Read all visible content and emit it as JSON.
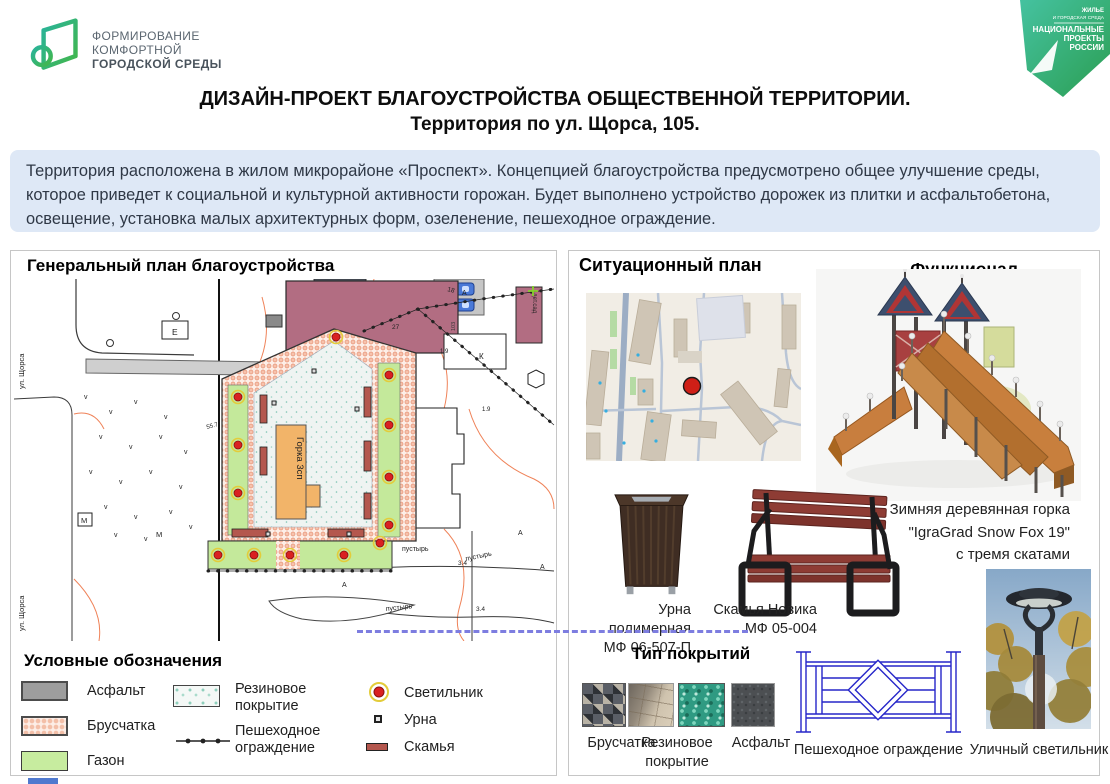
{
  "header": {
    "logo": {
      "line1": "ФОРМИРОВАНИЕ",
      "line2": "КОМФОРТНОЙ",
      "line3": "ГОРОДСКОЙ СРЕДЫ"
    },
    "badge": {
      "top1": "ЖИЛЬЕ",
      "top2": "И ГОРОДСКАЯ СРЕДА",
      "line1": "НАЦИОНАЛЬНЫЕ",
      "line2": "ПРОЕКТЫ",
      "line3": "РОССИИ"
    },
    "title_line1": "ДИЗАЙН-ПРОЕКТ БЛАГОУСТРОЙСТВА ОБЩЕСТВЕННОЙ ТЕРРИТОРИИ.",
    "title_line2": "Территория по ул. Щорса, 105."
  },
  "description": "Территория расположена в жилом микрорайоне «Проспект». Концепцией благоустройства предусмотрено общее улучшение среды, которое приведет к социальной и культурной активности горожан. Будет выполнено устройство дорожек из плитки и асфальтобетона, освещение, установка малых архитектурных форм, озеленение, пешеходное ограждение.",
  "general_plan": {
    "title": "Генеральный план благоустройства",
    "map_labels": {
      "slide": "Горка 3сп",
      "wasteland": "пустырь",
      "garages": "гаражи",
      "street": "ул. Щорса",
      "kindergarten": "дет.сад",
      "letter_a": "А",
      "letter_k": "К",
      "letter_m": "М",
      "letter_e": "Е",
      "num_27": "27",
      "num_18": "18",
      "num_19": "1.9",
      "num_34": "3.4",
      "num_557": "55.7",
      "building_103": "103"
    }
  },
  "legend": {
    "title": "Условные обозначения",
    "items": [
      {
        "label": "Асфальт"
      },
      {
        "label": "Брусчатка"
      },
      {
        "label": "Газон"
      },
      {
        "label": "Резиновое покрытие"
      },
      {
        "label": "Пешеходное ограждение"
      },
      {
        "label": "Светильник"
      },
      {
        "label": "Урна"
      },
      {
        "label": "Скамья"
      }
    ]
  },
  "situational_plan": {
    "title": "Ситуационный план"
  },
  "functional": {
    "title": "Функционал",
    "slide_caption": [
      "Зимняя деревянная горка",
      "\"IgraGrad Snow Fox 19\"",
      "с тремя скатами"
    ]
  },
  "furniture": {
    "urn_caption": [
      "Урна полимерная",
      "МФ 06-507-П"
    ],
    "bench_caption": [
      "Скамья Новика",
      "МФ 05-004"
    ]
  },
  "coverings": {
    "title": "Тип покрытий",
    "labels": [
      "Брусчатка",
      "Резиновое покрытие",
      "Асфальт"
    ],
    "fence_label": "Пешеходное ограждение",
    "lamp_label": "Уличный светильник"
  },
  "colors": {
    "accent_green": "#2fa25c",
    "accent_teal": "#28b09c",
    "band_blue": "#dee8f6",
    "lamp_red": "#d92121",
    "lawn_green": "#c4e99b",
    "paver_pink": "#f3c0aa",
    "fence_blue": "#2626c9"
  }
}
